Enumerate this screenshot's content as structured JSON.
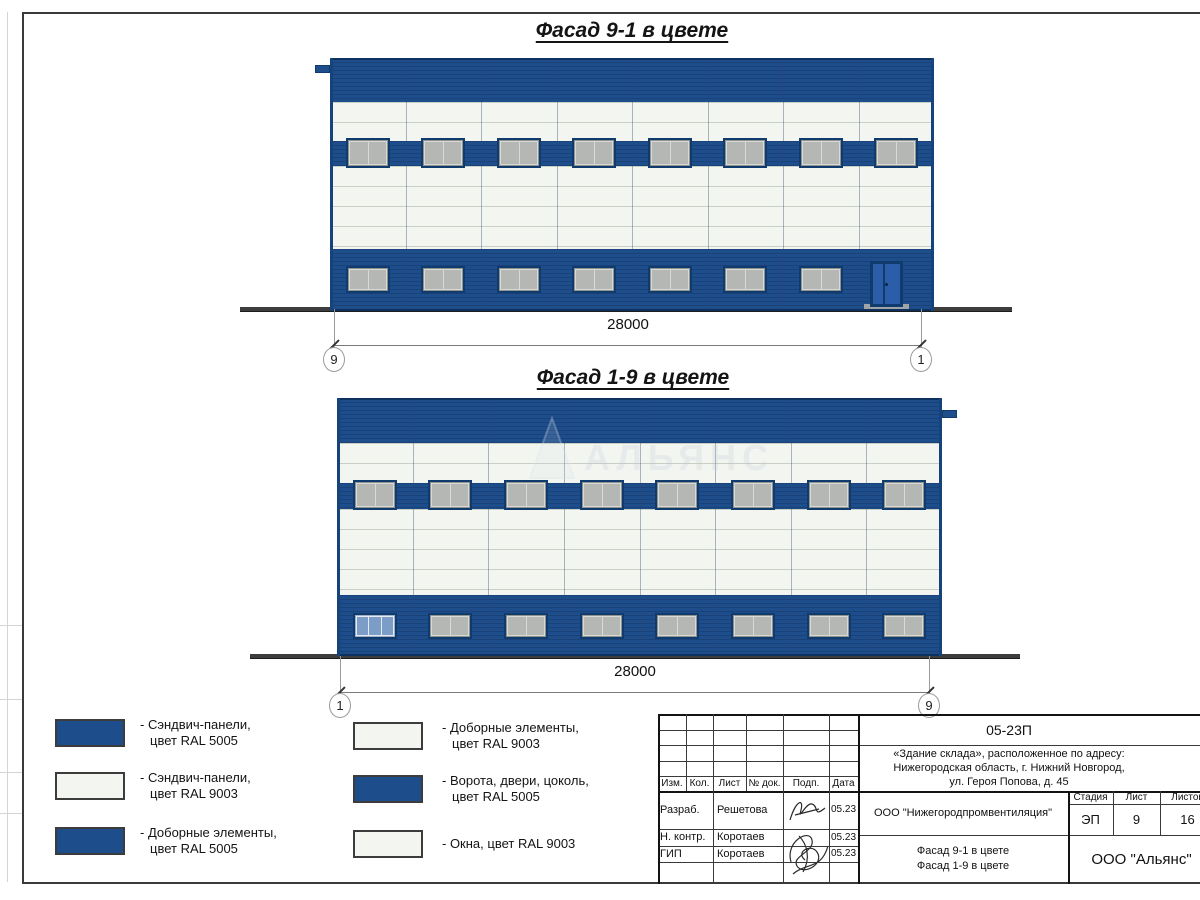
{
  "facade1": {
    "title": "Фасад 9-1 в цвете",
    "dimension": "28000",
    "axis_left": "9",
    "axis_right": "1",
    "bays": 8,
    "upper_windows": 8,
    "lower_windows": 7,
    "has_door": true
  },
  "facade2": {
    "title": "Фасад 1-9 в цвете",
    "dimension": "28000",
    "axis_left": "1",
    "axis_right": "9",
    "bays": 8,
    "upper_windows": 8,
    "lower_windows": 8,
    "first_window_glass": true
  },
  "watermark": {
    "text": "АЛЬЯНС"
  },
  "legend": {
    "items": [
      {
        "swatch": "ral5005",
        "lines": [
          "- Сэндвич-панели,",
          "цвет RAL 5005"
        ]
      },
      {
        "swatch": "ral9003",
        "lines": [
          "- Сэндвич-панели,",
          "цвет RAL 9003"
        ]
      },
      {
        "swatch": "ral5005",
        "lines": [
          "- Доборные элементы,",
          "цвет RAL 5005"
        ]
      },
      {
        "swatch": "ral9003",
        "lines": [
          "- Доборные элементы,",
          "цвет RAL 9003"
        ]
      },
      {
        "swatch": "ral5005",
        "lines": [
          "- Ворота, двери, цоколь,",
          "цвет RAL 5005"
        ]
      },
      {
        "swatch": "ral9003",
        "lines": [
          "- Окна, цвет RAL 9003"
        ]
      }
    ]
  },
  "titleblock": {
    "code": "05-23П",
    "address_lines": [
      "«Здание склада», расположенное по адресу:",
      "Нижегородская область, г. Нижний Новгород,",
      "ул. Героя Попова, д. 45"
    ],
    "sig_header": [
      "Изм.",
      "Кол.",
      "Лист",
      "№ док.",
      "Подп.",
      "Дата"
    ],
    "sig_rows": [
      {
        "role": "Разраб.",
        "name": "Решетова",
        "date": "05.23"
      },
      {
        "role": "Н. контр.",
        "name": "Коротаев",
        "date": "05.23"
      },
      {
        "role": "ГИП",
        "name": "Коротаев",
        "date": "05.23"
      }
    ],
    "org": "ООО \"Нижегородпромвентиляция\"",
    "doc_title_lines": [
      "Фасад 9-1 в цвете",
      "Фасад 1-9 в цвете"
    ],
    "stage_header": [
      "Стадия",
      "Лист",
      "Листов"
    ],
    "stage_values": [
      "ЭП",
      "9",
      "16"
    ],
    "company": "ООО \"Альянс\""
  },
  "colors": {
    "ral5005": "#1e4d8c",
    "ral9003": "#f3f5f0",
    "window_gray": "#b5b7b4",
    "door_blue": "#2b5da9",
    "ground": "#3d3d3d"
  }
}
